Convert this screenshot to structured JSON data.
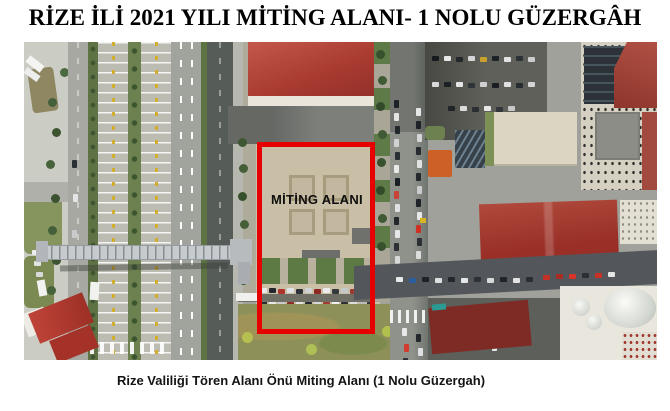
{
  "document": {
    "title": "RİZE İLİ 2021 YILI MİTİNG ALANI- 1 NOLU GÜZERGÂH",
    "caption": "Rize Valiliği Tören Alanı Önü Miting Alanı (1 Nolu Güzergah)"
  },
  "map": {
    "area_label": "MİTİNG ALANI",
    "annotation_color": "#e60000"
  }
}
